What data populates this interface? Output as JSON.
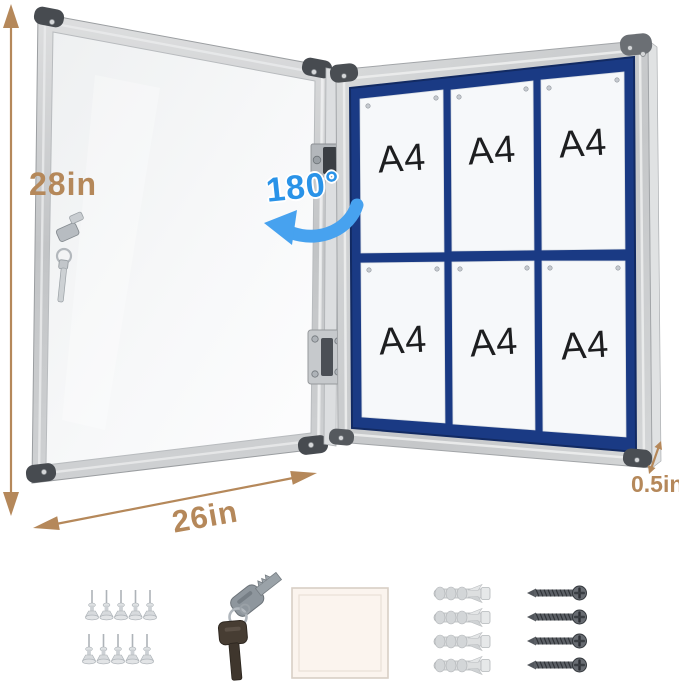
{
  "annotations": {
    "height_label": "28in",
    "width_label": "26in",
    "depth_label": "0.5in",
    "swing_label": "180°"
  },
  "board": {
    "rows": 2,
    "columns": 3,
    "sheet_labels": [
      "A4",
      "A4",
      "A4",
      "A4",
      "A4",
      "A4"
    ]
  },
  "accessories": {
    "push_pins": {
      "name": "push-pins",
      "count": 10
    },
    "keys": {
      "name": "keys",
      "count": 2
    },
    "felt_sheet": {
      "name": "felt-sheet",
      "count": 1
    },
    "wall_anchors": {
      "name": "wall-anchors",
      "count": 4
    },
    "screws": {
      "name": "screws",
      "count": 4
    }
  },
  "colors": {
    "dimension_tan": "#b5885a",
    "swing_blue": "#2a93e8",
    "felt_navy": "#1a3a84",
    "frame_silver": "#c9cbcd",
    "sheet_white": "#f6f8fa"
  }
}
